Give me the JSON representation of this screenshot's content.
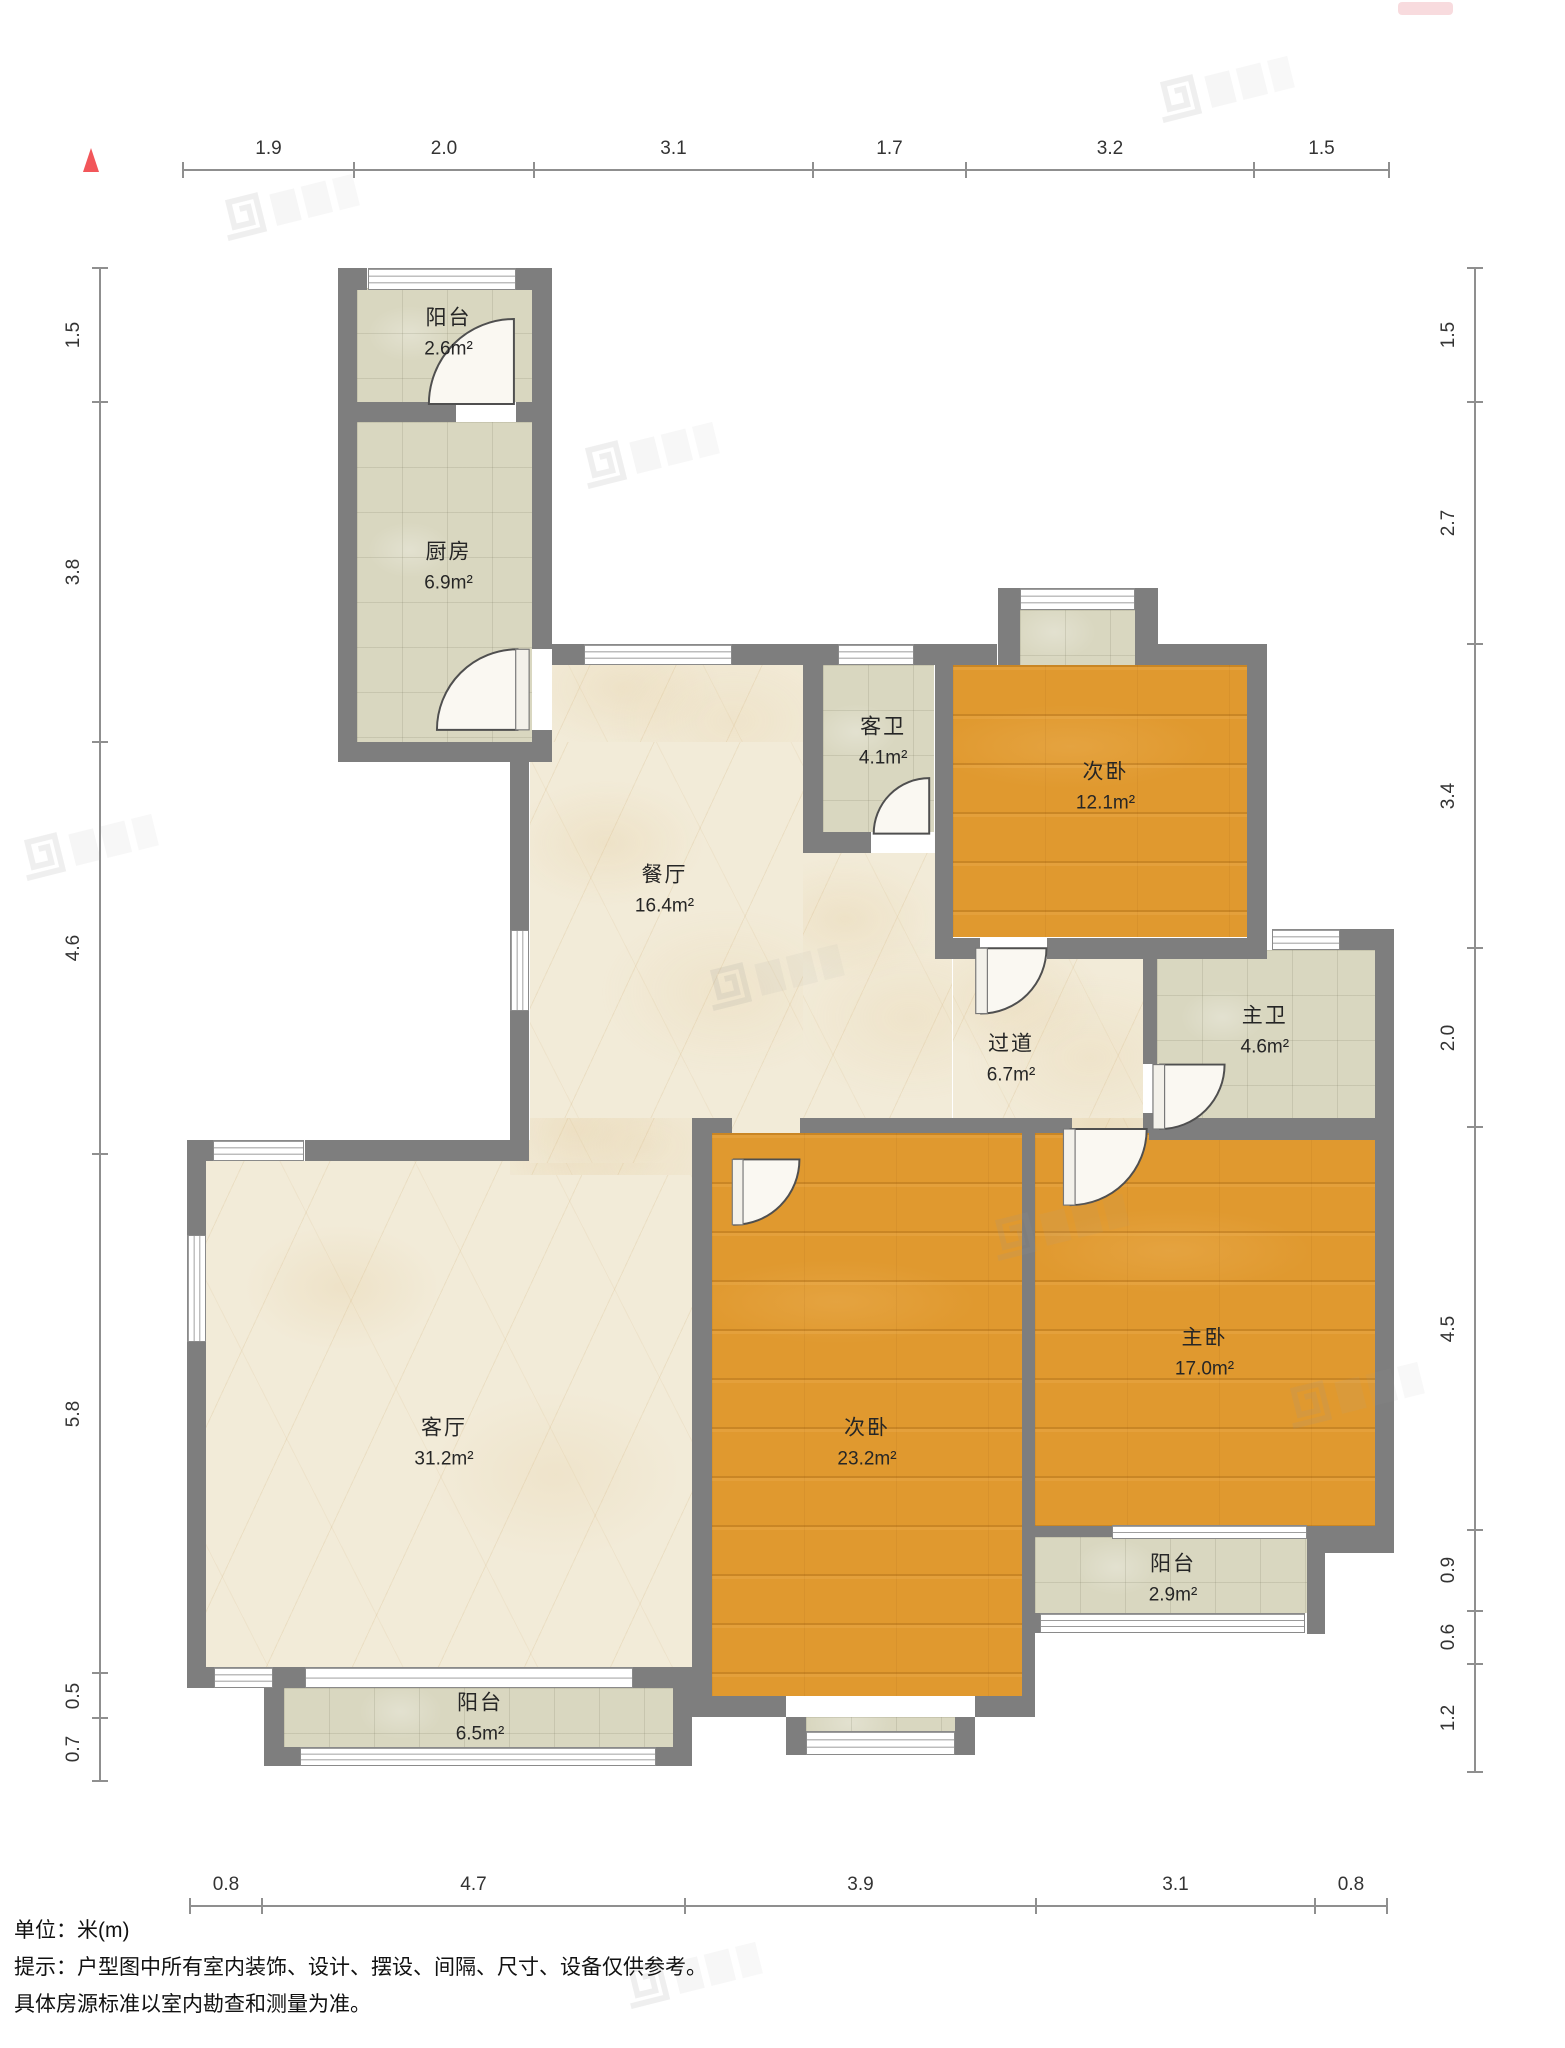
{
  "title": "户型图",
  "north_marker": {
    "shape": "triangle-up",
    "color": "#f2565a"
  },
  "dimensions": {
    "unit": "m",
    "top": [
      "1.9",
      "2.0",
      "3.1",
      "1.7",
      "3.2",
      "1.5"
    ],
    "bottom": [
      "0.8",
      "4.7",
      "3.9",
      "3.1",
      "0.8"
    ],
    "left": [
      "1.5",
      "3.8",
      "4.6",
      "5.8",
      "0.5",
      "0.7"
    ],
    "right": [
      "1.5",
      "2.7",
      "3.4",
      "2.0",
      "4.5",
      "0.9",
      "0.6",
      "1.2"
    ]
  },
  "rooms": [
    {
      "name": "阳台",
      "area": "2.6m²",
      "x": 2.95,
      "y": 0.7,
      "floor": "tile"
    },
    {
      "name": "厨房",
      "area": "6.9m²",
      "x": 2.95,
      "y": 3.32,
      "floor": "tile"
    },
    {
      "name": "餐厅",
      "area": "16.4m²",
      "x": 5.35,
      "y": 6.93,
      "floor": "cream"
    },
    {
      "name": "客卫",
      "area": "4.1m²",
      "x": 7.78,
      "y": 5.27,
      "floor": "tile"
    },
    {
      "name": "次卧",
      "area": "12.1m²",
      "x": 10.25,
      "y": 5.78,
      "floor": "wood"
    },
    {
      "name": "主卫",
      "area": "4.6m²",
      "x": 12.02,
      "y": 8.5,
      "floor": "tile"
    },
    {
      "name": "过道",
      "area": "6.7m²",
      "x": 9.2,
      "y": 8.82,
      "floor": "cream"
    },
    {
      "name": "客厅",
      "area": "31.2m²",
      "x": 2.9,
      "y": 13.1,
      "floor": "cream"
    },
    {
      "name": "次卧",
      "area": "23.2m²",
      "x": 7.6,
      "y": 13.1,
      "floor": "wood"
    },
    {
      "name": "主卧",
      "area": "17.0m²",
      "x": 11.35,
      "y": 12.1,
      "floor": "wood"
    },
    {
      "name": "阳台",
      "area": "2.9m²",
      "x": 11.0,
      "y": 14.62,
      "floor": "tile"
    },
    {
      "name": "阳台",
      "area": "6.5m²",
      "x": 3.3,
      "y": 16.18,
      "floor": "tile"
    }
  ],
  "footer": {
    "unit_line": "单位：米(m)",
    "tip_line1": "提示：户型图中所有室内装饰、设计、摆设、间隔、尺寸、设备仅供参考。",
    "tip_line2": "具体房源标准以室内勘查和测量为准。"
  }
}
